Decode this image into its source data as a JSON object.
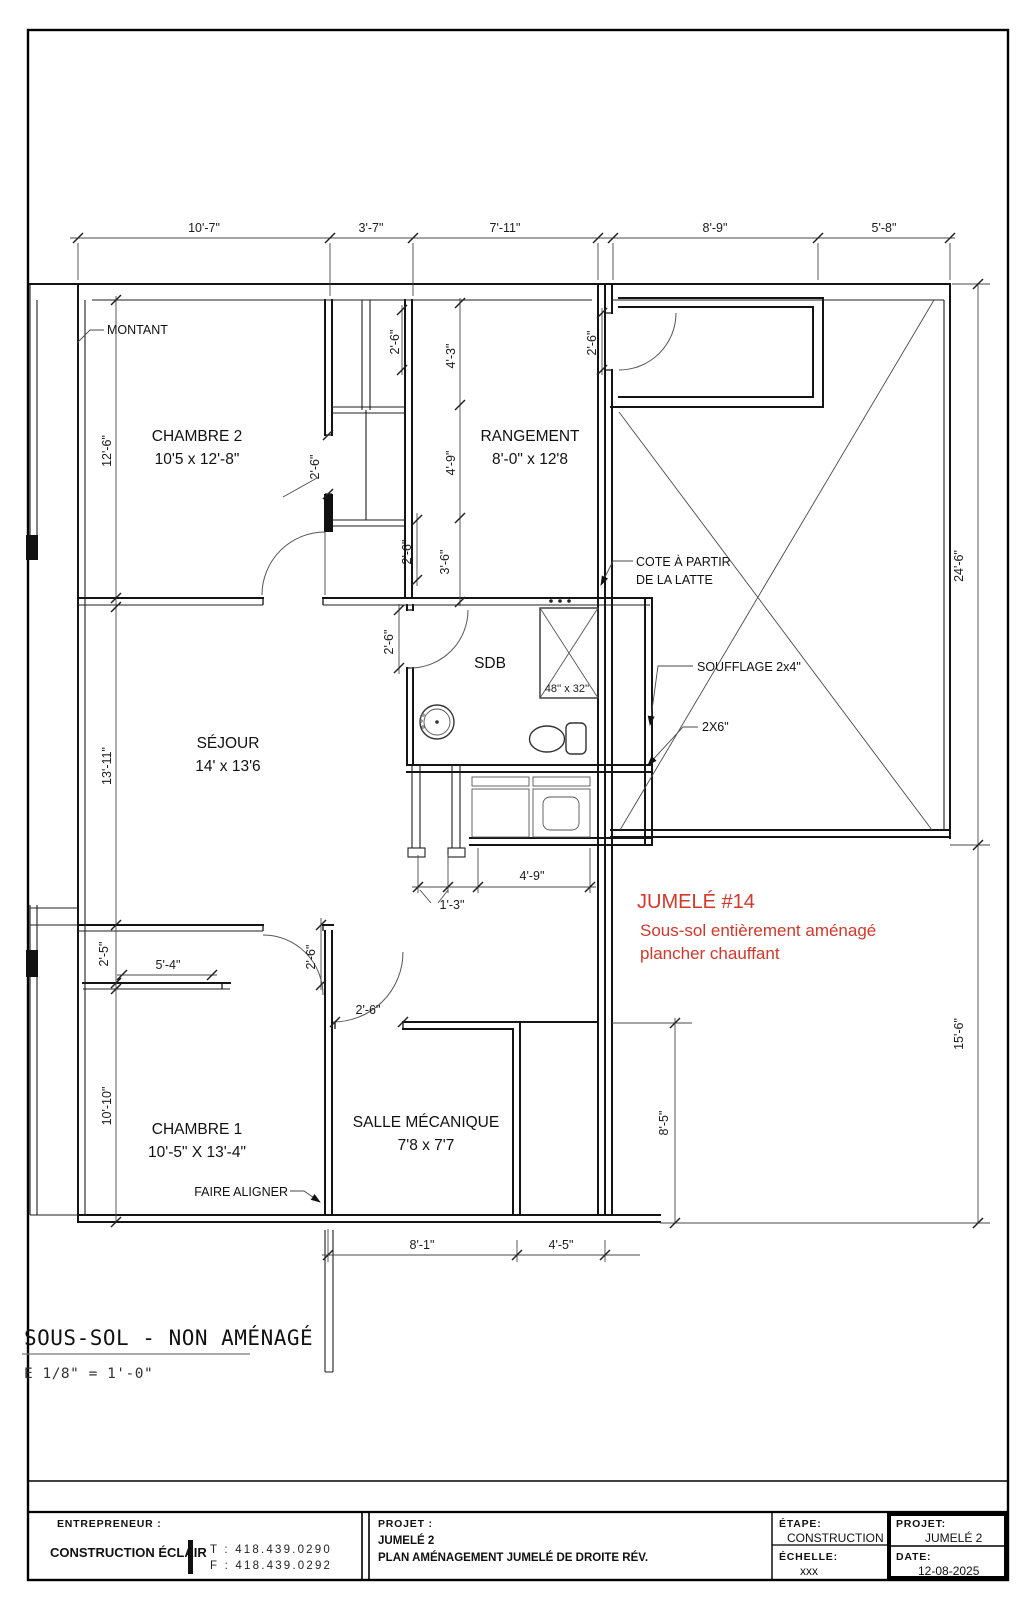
{
  "page": {
    "sheet_title": "SOUS-SOL - NON AMÉNAGÉ",
    "scale_note": "E 1/8\" = 1'-0\""
  },
  "plan": {
    "rooms": [
      {
        "name": "CHAMBRE 2",
        "size": "10'5 x 12'-8\""
      },
      {
        "name": "RANGEMENT",
        "size": "8'-0\" x 12'8"
      },
      {
        "name": "SÉJOUR",
        "size": "14' x 13'6"
      },
      {
        "name": "SDB",
        "size": ""
      },
      {
        "name": "CHAMBRE 1",
        "size": "10'-5\" X 13'-4\""
      },
      {
        "name": "SALLE MÉCANIQUE",
        "size": "7'8 x 7'7"
      }
    ],
    "dims": {
      "top": [
        "10'-7\"",
        "3'-7\"",
        "7'-11\"",
        "8'-9\"",
        "5'-8\""
      ],
      "left": [
        "12'-6\"",
        "13'-11\"",
        "2'-5\"",
        "10'-10\""
      ],
      "right": [
        "24'-6\"",
        "15'-6\"",
        "8'-5\""
      ],
      "stairs": [
        "2'-6\"",
        "4'-3\"",
        "4'-9\"",
        "3'-6\"",
        "2'-6\"",
        "2'-6\""
      ],
      "doors": [
        "2'-6\"",
        "2'-6\"",
        "2'-6\"",
        "2'-6\""
      ],
      "bottom": [
        "1'-3\"",
        "4'-9\"",
        "8'-1\"",
        "4'-5\"",
        "5'-4\""
      ],
      "shower": "48'' x 32''"
    },
    "annotations": {
      "montant": "MONTANT",
      "cote_line1": "COTE À PARTIR",
      "cote_line2": "DE LA LATTE",
      "soufflage": "SOUFFLAGE 2x4\"",
      "two_by_six": "2X6\"",
      "faire_aligner": "FAIRE ALIGNER"
    },
    "notes_red": {
      "title": "JUMELÉ #14",
      "line1": "Sous-sol entièrement aménagé",
      "line2": "plancher chauffant",
      "color": "#d5372a"
    }
  },
  "titleblock": {
    "entrepreneur_label": "ENTREPRENEUR :",
    "entrepreneur_name": "CONSTRUCTION ÉCLAIR",
    "phone_t": "T : 418.439.0290",
    "phone_f": "F : 418.439.0292",
    "projet_label": "PROJET :",
    "projet_name": "JUMELÉ 2",
    "projet_desc": "PLAN AMÉNAGEMENT JUMELÉ DE DROITE RÉV.",
    "etape_label": "ÉTAPE:",
    "etape_value": "CONSTRUCTION",
    "echelle_label": "ÉCHELLE:",
    "echelle_value": "xxx",
    "projet2_label": "PROJET:",
    "projet2_value": "JUMELÉ 2",
    "date_label": "DATE:",
    "date_value": "12-08-2025"
  }
}
